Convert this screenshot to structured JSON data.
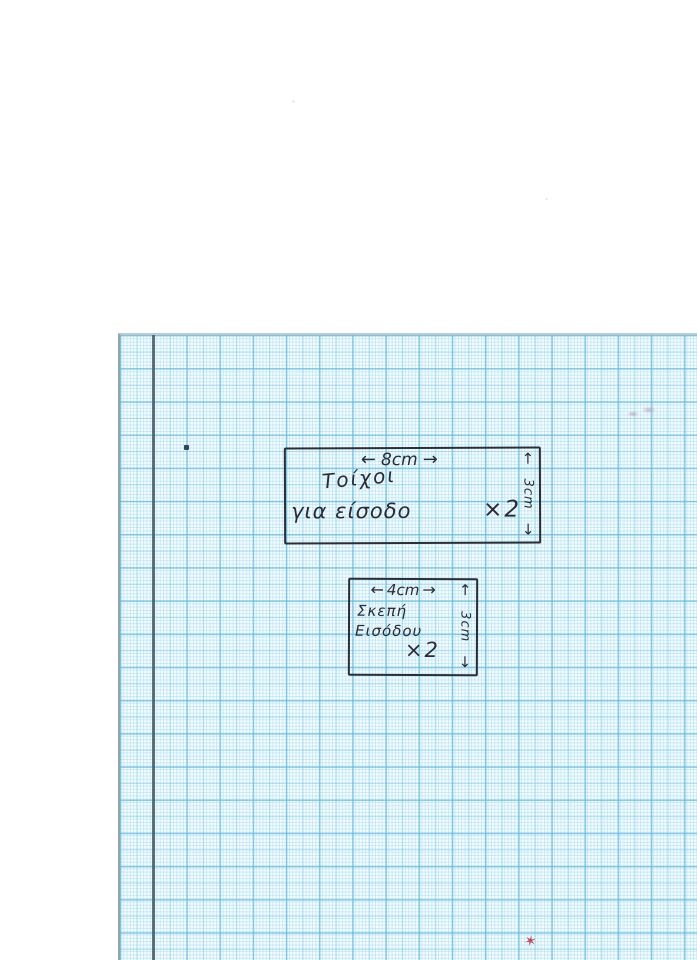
{
  "paper": {
    "background_color": "#f6fcfe",
    "grid_fine_color": "#bfe5f2",
    "grid_mid_color": "#9ed8ec",
    "grid_bold_color": "#7fcbe4",
    "margin_line_color": "#4b5a66",
    "ink_color": "#2b2b33"
  },
  "icons": {
    "arrow_left": "←",
    "arrow_right": "→",
    "arrow_up": "↑",
    "arrow_down": "↓"
  },
  "sketches": [
    {
      "name": "walls-for-entrance",
      "width_label": "8cm",
      "height_label": "3cm",
      "label_line1": "Τοίχοι",
      "label_line2": "για είσοδο",
      "quantity": "×2"
    },
    {
      "name": "entrance-roof",
      "width_label": "4cm",
      "height_label": "3cm",
      "label_line1": "Σκεπή",
      "label_line2": "Εισόδου",
      "quantity": "×2"
    }
  ],
  "marks": {
    "red_mark": "✶"
  }
}
